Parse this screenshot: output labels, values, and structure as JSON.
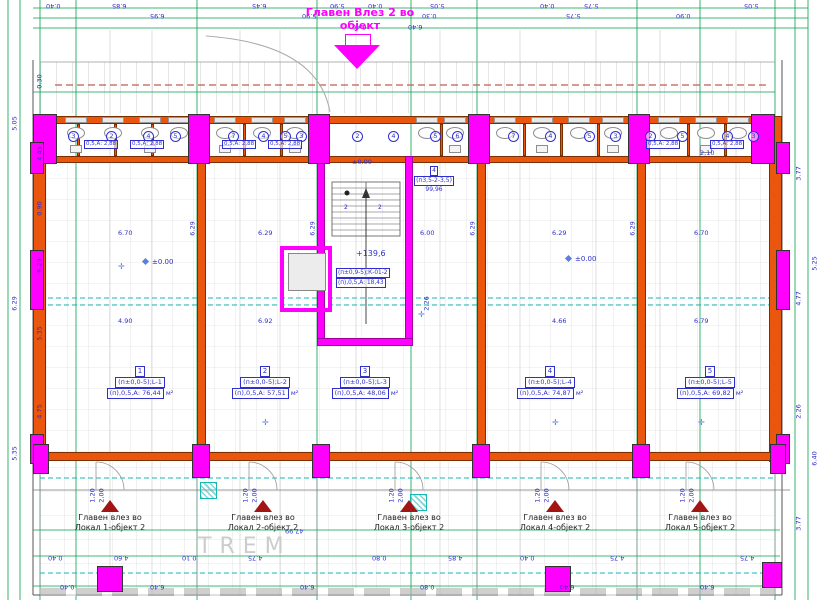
{
  "title": {
    "line1": "Главен Влез 2 во",
    "line2": "објект"
  },
  "porch": {
    "label": "TREM"
  },
  "stair": {
    "elevation_street": "±0.00",
    "elevation_landing": "+139,6",
    "flights": [
      "2",
      "2"
    ]
  },
  "core_room": {
    "code": "(п±0,9-5);К-01-2",
    "area": "(п),0,5,А: 18,43"
  },
  "corridor_room": {
    "num": "4",
    "code": "(п3,5-2-3,5)",
    "area": "99,96"
  },
  "rooms": [
    {
      "num": "1",
      "code": "(п±0,0-5);L-1",
      "area": "(п),0,5,А: 76,44",
      "unit": "м²"
    },
    {
      "num": "2",
      "code": "(п±0,0-5);L-2",
      "area": "(п),0,5,А: 57,51",
      "unit": "м²"
    },
    {
      "num": "3",
      "code": "(п±0,0-5);L-3",
      "area": "(п),0,5,А: 48,06",
      "unit": "м²"
    },
    {
      "num": "4",
      "code": "(п±0,0-5);L-4",
      "area": "(п),0,5,А: 74,87",
      "unit": "м²"
    },
    {
      "num": "5",
      "code": "(п±0,0-5);L-5",
      "area": "(п),0,5,А: 69,82",
      "unit": "м²"
    }
  ],
  "entrances": [
    {
      "line1": "Главен влез во",
      "line2": "Локал 1-објект 2"
    },
    {
      "line1": "Главен влез во",
      "line2": "Локал 2-објект 2"
    },
    {
      "line1": "Главен влез во",
      "line2": "Локал 3-објект 2"
    },
    {
      "line1": "Главен влез во",
      "line2": "Локал 4-објект 2"
    },
    {
      "line1": "Главен влез во",
      "line2": "Локал 5-објект 2"
    }
  ],
  "elevation_markers": [
    {
      "text": "±0.00",
      "x": 143,
      "y": 258
    },
    {
      "text": "±0.00",
      "x": 566,
      "y": 255
    }
  ],
  "top_strip": {
    "unit_numbers": [
      {
        "n": "3",
        "x": 68
      },
      {
        "n": "2",
        "x": 106
      },
      {
        "n": "4",
        "x": 143
      },
      {
        "n": "5",
        "x": 170
      },
      {
        "n": "7",
        "x": 228
      },
      {
        "n": "4",
        "x": 258
      },
      {
        "n": "5",
        "x": 280
      },
      {
        "n": "3",
        "x": 296
      },
      {
        "n": "2",
        "x": 352
      },
      {
        "n": "4",
        "x": 388
      },
      {
        "n": "5",
        "x": 430
      },
      {
        "n": "6",
        "x": 452
      },
      {
        "n": "7",
        "x": 508
      },
      {
        "n": "4",
        "x": 545
      },
      {
        "n": "5",
        "x": 584
      },
      {
        "n": "3",
        "x": 610
      },
      {
        "n": "2",
        "x": 645
      },
      {
        "n": "5",
        "x": 677
      },
      {
        "n": "4",
        "x": 722
      },
      {
        "n": "3",
        "x": 748
      }
    ],
    "area_labels": [
      {
        "t": "0,5,А: 2,88",
        "x": 84
      },
      {
        "t": "0,5,А: 2,88",
        "x": 130
      },
      {
        "t": "0,5,А: 2,88",
        "x": 222
      },
      {
        "t": "0,5,А: 2,88",
        "x": 268
      },
      {
        "t": "0,5,А: 2,88",
        "x": 646
      },
      {
        "t": "0,5,А: 2,88",
        "x": 710
      }
    ]
  },
  "dimensions": [
    {
      "t": "0.40",
      "x": 46,
      "y": 2,
      "r": 180
    },
    {
      "t": "6.85",
      "x": 112,
      "y": 2,
      "r": 180
    },
    {
      "t": "6.45",
      "x": 252,
      "y": 2,
      "r": 180
    },
    {
      "t": "5.90",
      "x": 330,
      "y": 2,
      "r": 180
    },
    {
      "t": "0.40",
      "x": 368,
      "y": 2,
      "r": 180
    },
    {
      "t": "5.05",
      "x": 430,
      "y": 2,
      "r": 180
    },
    {
      "t": "0.40",
      "x": 540,
      "y": 2,
      "r": 180
    },
    {
      "t": "5.75",
      "x": 584,
      "y": 2,
      "r": 180
    },
    {
      "t": "5.05",
      "x": 744,
      "y": 2,
      "r": 180
    },
    {
      "t": "6.95",
      "x": 150,
      "y": 12,
      "r": 180
    },
    {
      "t": "5.90",
      "x": 302,
      "y": 12,
      "r": 180
    },
    {
      "t": "0.30",
      "x": 422,
      "y": 12,
      "r": 180
    },
    {
      "t": "5.75",
      "x": 566,
      "y": 12,
      "r": 180
    },
    {
      "t": "0.90",
      "x": 676,
      "y": 12,
      "r": 180
    },
    {
      "t": "6.40",
      "x": 352,
      "y": 23,
      "r": 180
    },
    {
      "t": "6.40",
      "x": 408,
      "y": 23,
      "r": 180
    },
    {
      "t": "0.30",
      "x": 33,
      "y": 78,
      "r": 90
    },
    {
      "t": "4.45",
      "x": 33,
      "y": 150,
      "r": 90
    },
    {
      "t": "0.90",
      "x": 33,
      "y": 205,
      "r": 90
    },
    {
      "t": "6.29",
      "x": 33,
      "y": 262,
      "r": 90
    },
    {
      "t": "5.35",
      "x": 33,
      "y": 330,
      "r": 90
    },
    {
      "t": "4.75",
      "x": 33,
      "y": 408,
      "r": 90
    },
    {
      "t": "5.05",
      "x": 8,
      "y": 120,
      "r": 90
    },
    {
      "t": "6.29",
      "x": 8,
      "y": 300,
      "r": 90
    },
    {
      "t": "5.35",
      "x": 8,
      "y": 450,
      "r": 90
    },
    {
      "t": "3.77",
      "x": 792,
      "y": 170,
      "r": 90
    },
    {
      "t": "4.77",
      "x": 792,
      "y": 295,
      "r": 90
    },
    {
      "t": "2.26",
      "x": 792,
      "y": 408,
      "r": 90
    },
    {
      "t": "3.77",
      "x": 792,
      "y": 520,
      "r": 90
    },
    {
      "t": "5.25",
      "x": 808,
      "y": 260,
      "r": 90
    },
    {
      "t": "6.40",
      "x": 808,
      "y": 455,
      "r": 90
    },
    {
      "t": "6.70",
      "x": 118,
      "y": 230
    },
    {
      "t": "6.29",
      "x": 258,
      "y": 230
    },
    {
      "t": "6.00",
      "x": 420,
      "y": 230
    },
    {
      "t": "6.29",
      "x": 552,
      "y": 230
    },
    {
      "t": "6.70",
      "x": 694,
      "y": 230
    },
    {
      "t": "4.90",
      "x": 118,
      "y": 318
    },
    {
      "t": "6.92",
      "x": 258,
      "y": 318
    },
    {
      "t": "4.66",
      "x": 552,
      "y": 318
    },
    {
      "t": "6.79",
      "x": 694,
      "y": 318
    },
    {
      "t": "6.29",
      "x": 186,
      "y": 225,
      "r": 90
    },
    {
      "t": "6.29",
      "x": 306,
      "y": 225,
      "r": 90
    },
    {
      "t": "6.29",
      "x": 466,
      "y": 225,
      "r": 90
    },
    {
      "t": "6.29",
      "x": 626,
      "y": 225,
      "r": 90
    },
    {
      "t": "2.26",
      "x": 420,
      "y": 300,
      "r": 90
    },
    {
      "t": "2,10",
      "x": 700,
      "y": 150
    },
    {
      "t": "47.99",
      "x": 285,
      "y": 527,
      "r": 180
    },
    {
      "t": "0.40",
      "x": 48,
      "y": 554,
      "r": 180
    },
    {
      "t": "4.60",
      "x": 114,
      "y": 554,
      "r": 180
    },
    {
      "t": "0.10",
      "x": 182,
      "y": 554,
      "r": 180
    },
    {
      "t": "4.75",
      "x": 248,
      "y": 554,
      "r": 180
    },
    {
      "t": "0.80",
      "x": 372,
      "y": 554,
      "r": 180
    },
    {
      "t": "4.85",
      "x": 448,
      "y": 554,
      "r": 180
    },
    {
      "t": "0.40",
      "x": 520,
      "y": 554,
      "r": 180
    },
    {
      "t": "4.75",
      "x": 610,
      "y": 554,
      "r": 180
    },
    {
      "t": "4.75",
      "x": 740,
      "y": 554,
      "r": 180
    },
    {
      "t": "0.40",
      "x": 60,
      "y": 583,
      "r": 180
    },
    {
      "t": "6.40",
      "x": 150,
      "y": 583,
      "r": 180
    },
    {
      "t": "6.40",
      "x": 300,
      "y": 583,
      "r": 180
    },
    {
      "t": "0.80",
      "x": 420,
      "y": 583,
      "r": 180
    },
    {
      "t": "6.40",
      "x": 560,
      "y": 583,
      "r": 180
    },
    {
      "t": "6.40",
      "x": 700,
      "y": 583,
      "r": 180
    },
    {
      "t": "1,20",
      "x": 86,
      "y": 492,
      "r": 90
    },
    {
      "t": "2,00",
      "x": 95,
      "y": 492,
      "r": 90
    },
    {
      "t": "1,20",
      "x": 239,
      "y": 492,
      "r": 90
    },
    {
      "t": "2,00",
      "x": 248,
      "y": 492,
      "r": 90
    },
    {
      "t": "1,20",
      "x": 385,
      "y": 492,
      "r": 90
    },
    {
      "t": "2,00",
      "x": 394,
      "y": 492,
      "r": 90
    },
    {
      "t": "1,20",
      "x": 531,
      "y": 492,
      "r": 90
    },
    {
      "t": "2,00",
      "x": 540,
      "y": 492,
      "r": 90
    },
    {
      "t": "1,20",
      "x": 676,
      "y": 492,
      "r": 90
    },
    {
      "t": "2,00",
      "x": 685,
      "y": 492,
      "r": 90
    }
  ],
  "colors": {
    "wall_orange": "#EA560D",
    "highlight_magenta": "#FF00FF",
    "axis_green": "#00A14B",
    "dim_blue": "#2F2FCB",
    "utility_cyan": "#19B6B6",
    "dashed_red": "#C25B4E",
    "entrance_red": "#A31515"
  }
}
